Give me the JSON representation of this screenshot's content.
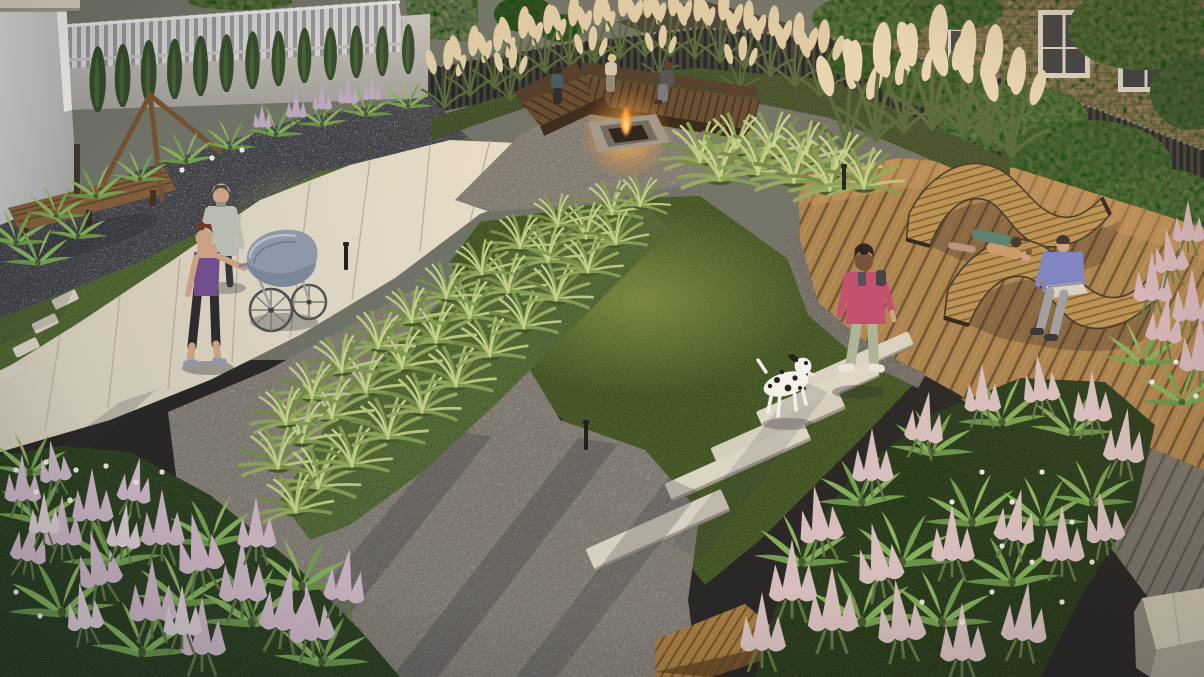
{
  "scene": {
    "title": "Courtyard garden landscape 3D visualization",
    "view": "elevated aerial view at golden hour",
    "no_visible_text": true
  },
  "palette": {
    "lawn": "#4f6a33",
    "lawn_dark": "#3d5427",
    "concrete_path": "#ddd5c5",
    "gravel": "#8e8a82",
    "dark_gravel_bed": "#454a53",
    "deck_wood": "#a8804c",
    "deck_wood_shaded": "#76736b",
    "bench_wood": "#5e452c",
    "privacy_fence": "#1d2123",
    "picket_fence": "#cdd0d2",
    "wall": "#b4b5b2",
    "brick_building": "#977e64",
    "house_roof": "#3f3c37",
    "pampas_plume": "#dccb a8",
    "astilbe_lavender": "#c9b4c4",
    "astilbe_pink": "#d6bfc0",
    "fern_green": "#7fae5a",
    "fire_flame": "#ff9a2a",
    "pram_fabric": "#8a97ab",
    "jacket_pink": "#c04a6e",
    "tank_purple": "#6b4a8e",
    "blazer_sage": "#b9bdb4",
    "tshirt_periwinkle": "#7381c9",
    "dog_coat": "#f2f2ee"
  },
  "objects": {
    "building_left": {
      "label": "White plastered building wall, top left corner"
    },
    "picket_fence": {
      "label": "Light grey picket fence on top of garden wall"
    },
    "garden_wall": {
      "label": "Light grey boundary wall"
    },
    "privacy_fence": {
      "label": "Dark vertical-slat privacy fence along back and right"
    },
    "house": {
      "label": "Neighbouring house roof behind fence"
    },
    "brick_building": {
      "label": "Old brick apartment building with tall windows"
    },
    "trees": {
      "label": "Tree canopies behind fence"
    },
    "ivy": {
      "label": "Ivy growing over the dark fence"
    },
    "thuja_hedge": {
      "label": "Row of columnar evergreens along back wall"
    },
    "garden_bench": {
      "label": "Wooden bench on dark gravel bed"
    },
    "swing_frame": {
      "label": "Wooden swing frame beside bench"
    },
    "planting_bed_top": {
      "label": "Fern and astilbe bed along the wall"
    },
    "lawn_upper": {
      "label": "Upper left lawn"
    },
    "lawn_main": {
      "label": "Central lawn"
    },
    "concrete_path": {
      "label": "Wide concrete walkway crossing the garden"
    },
    "stepping_stones": {
      "label": "Small stepping stones to the bench"
    },
    "fire_pit_area": {
      "label": "Gravel fire pit lounge corner"
    },
    "corner_bench": {
      "label": "L-shaped wooden corner bench"
    },
    "fire_pit": {
      "label": "Square concrete fire pit with burning fire"
    },
    "seated_person_1": {
      "label": "Woman in dark top seated at fire pit"
    },
    "seated_person_2": {
      "label": "Blonde woman in light top seated at fire pit"
    },
    "seated_person_3": {
      "label": "Man in grey jacket seated at fire pit"
    },
    "pampas_grass": {
      "label": "Tall pampas grass with cream plumes along fence"
    },
    "ornamental_grass_band": {
      "label": "Diagonal band of fountain grass clumps"
    },
    "fountain_grass": {
      "label": "Soft fountain grasses by the deck"
    },
    "gravel_area": {
      "label": "Large gravel surface with long evening shadows"
    },
    "deck": {
      "label": "Diagonal-plank timber deck terrace"
    },
    "gravel_border": {
      "label": "Gravel border strip along deck edge"
    },
    "wave_lounger_1": {
      "label": "Curved wooden wave lounger (far)"
    },
    "wave_lounger_2": {
      "label": "Curved wooden wave lounger (near)"
    },
    "lounging_couple": {
      "label": "Couple lying on the far wave lounger"
    },
    "man_with_laptop": {
      "label": "Man in blue shirt sitting with laptop on lounger"
    },
    "plank_path": {
      "label": "Concrete plank pavers set into lawn"
    },
    "platform_bench": {
      "label": "Slatted timber platform bench on gravel"
    },
    "concrete_cube": {
      "label": "Concrete cube seat at deck corner"
    },
    "flower_bed_left": {
      "label": "Astilbe and fern flower bed, lower left"
    },
    "flower_bed_right": {
      "label": "Astilbe, fern and geranium bed, lower right"
    },
    "path_lights": {
      "label": "Small black bollard path lights"
    },
    "woman_in_blazer": {
      "label": "Blonde woman in sage blazer standing on path"
    },
    "woman_with_pram": {
      "label": "Woman in purple tank top pushing a pram"
    },
    "pram": {
      "label": "Grey-blue vintage pram with spoked wheels"
    },
    "woman_walking_dog": {
      "label": "Woman in pink jacket walking on plank pavers"
    },
    "dalmatian_dog": {
      "label": "Dalmatian dog walking ahead"
    },
    "sunlight": {
      "label": "Warm low sunlight from upper right casting long shadows"
    }
  }
}
